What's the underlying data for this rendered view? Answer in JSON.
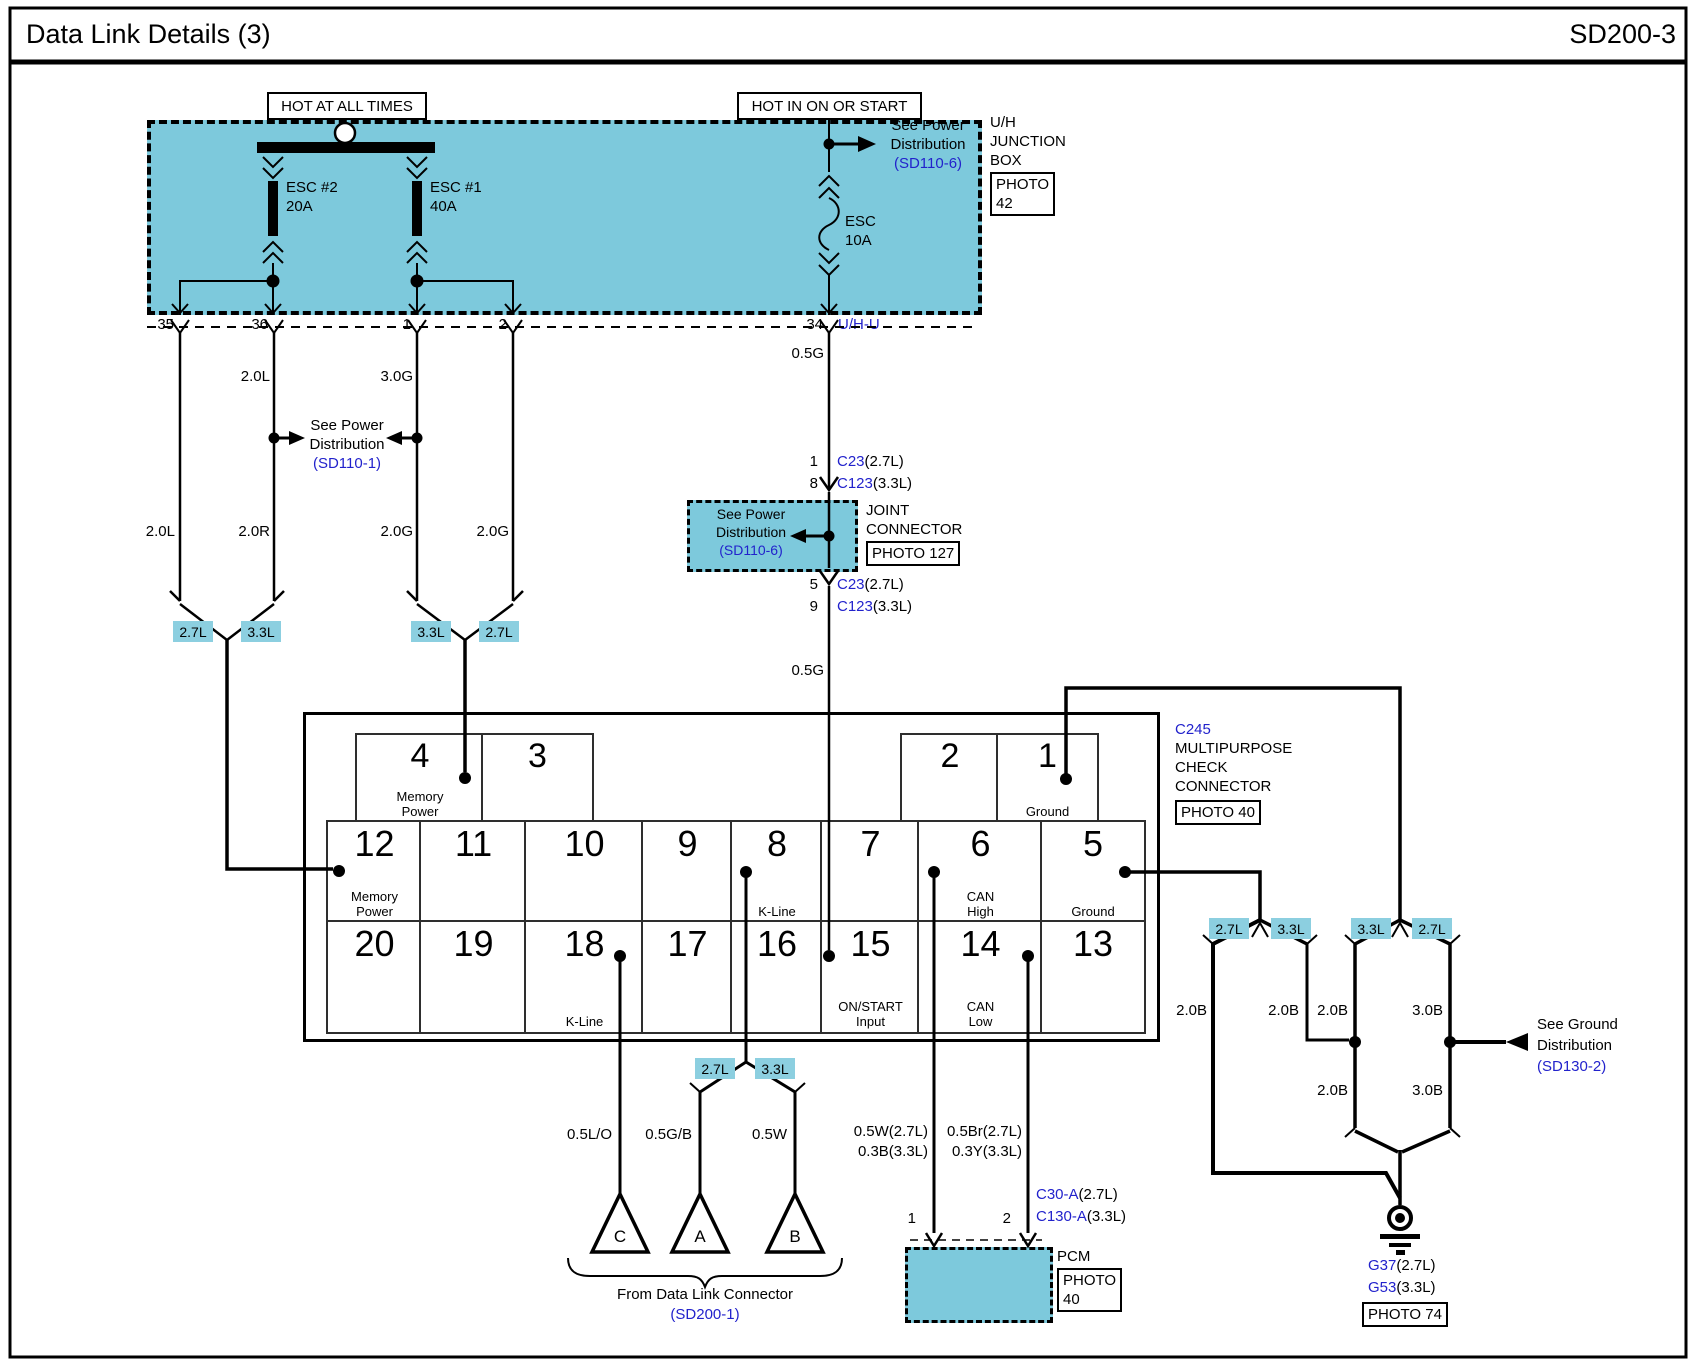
{
  "page": {
    "title": "Data Link Details (3)",
    "code": "SD200-3"
  },
  "colors": {
    "box_fill": "#7dc9dc",
    "tag_fill": "#8ccfe0",
    "link_blue": "#2222cc"
  },
  "top": {
    "hot1": "HOT AT ALL TIMES",
    "hot2": "HOT IN ON OR START",
    "fuse_esc2": {
      "name": "ESC #2",
      "amp": "20A"
    },
    "fuse_esc1": {
      "name": "ESC #1",
      "amp": "40A"
    },
    "fuse_esc": {
      "name": "ESC",
      "amp": "10A"
    },
    "see_power_right": {
      "l1": "See Power",
      "l2": "Distribution",
      "ref": "(SD110-6)"
    },
    "uh": {
      "l1": "U/H",
      "l2": "JUNCTION",
      "l3": "BOX",
      "photo1": "PHOTO",
      "photo2": "42"
    },
    "pins": {
      "p35": "35",
      "p36": "36",
      "p1": "1",
      "p2": "2",
      "p34": "34",
      "uhu": "U/H-U"
    }
  },
  "mid": {
    "w36": "2.0L",
    "w1": "3.0G",
    "w34": "0.5G",
    "w34b": "0.5G",
    "see_power": {
      "l1": "See Power",
      "l2": "Distribution",
      "ref": "(SD110-1)"
    },
    "low35": "2.0L",
    "low36": "2.0R",
    "low1": "2.0G",
    "low2": "2.0G",
    "tagL1": "2.7L",
    "tagL2": "3.3L",
    "tagR1": "3.3L",
    "tagR2": "2.7L"
  },
  "joint": {
    "p1": "1",
    "p8": "8",
    "p5": "5",
    "p9": "9",
    "c27": "C23",
    "c27e": "(2.7L)",
    "c33": "C123",
    "c33e": "(3.3L)",
    "see_power": {
      "l1": "See Power",
      "l2": "Distribution",
      "ref": "(SD110-6)"
    },
    "name1": "JOINT",
    "name2": "CONNECTOR",
    "photo": "PHOTO 127"
  },
  "connector": {
    "id": "C245",
    "n1": "MULTIPURPOSE",
    "n2": "CHECK",
    "n3": "CONNECTOR",
    "photo": "PHOTO 40",
    "top_left": [
      {
        "num": "4",
        "l1": "Memory",
        "l2": "Power"
      },
      {
        "num": "3",
        "l1": "",
        "l2": ""
      }
    ],
    "top_right": [
      {
        "num": "2",
        "l1": "",
        "l2": ""
      },
      {
        "num": "1",
        "l1": "Ground",
        "l2": ""
      }
    ],
    "row1": [
      {
        "num": "12",
        "l1": "Memory",
        "l2": "Power"
      },
      {
        "num": "11",
        "l1": "",
        "l2": ""
      },
      {
        "num": "10",
        "l1": "",
        "l2": ""
      },
      {
        "num": "9",
        "l1": "",
        "l2": ""
      },
      {
        "num": "8",
        "l1": "K-Line",
        "l2": ""
      },
      {
        "num": "7",
        "l1": "",
        "l2": ""
      },
      {
        "num": "6",
        "l1": "CAN",
        "l2": "High"
      },
      {
        "num": "5",
        "l1": "Ground",
        "l2": ""
      }
    ],
    "row2": [
      {
        "num": "20",
        "l1": "",
        "l2": ""
      },
      {
        "num": "19",
        "l1": "",
        "l2": ""
      },
      {
        "num": "18",
        "l1": "K-Line",
        "l2": ""
      },
      {
        "num": "17",
        "l1": "",
        "l2": ""
      },
      {
        "num": "16",
        "l1": "",
        "l2": ""
      },
      {
        "num": "15",
        "l1": "ON/START",
        "l2": "Input"
      },
      {
        "num": "14",
        "l1": "CAN",
        "l2": "Low"
      },
      {
        "num": "13",
        "l1": "",
        "l2": ""
      }
    ]
  },
  "bottom": {
    "w18": "0.5L/O",
    "wA": "0.5G/B",
    "wB": "0.5W",
    "tag27": "2.7L",
    "tag33": "3.3L",
    "triC": "C",
    "triA": "A",
    "triB": "B",
    "brace": "From Data Link Connector",
    "brace_ref": "(SD200-1)",
    "pcm_w1a": "0.5W(2.7L)",
    "pcm_w1b": "0.3B(3.3L)",
    "pcm_w2a": "0.5Br(2.7L)",
    "pcm_w2b": "0.3Y(3.3L)",
    "pcm": {
      "p1": "1",
      "p2": "2",
      "c27": "C30-A",
      "c27e": "(2.7L)",
      "c33": "C130-A",
      "c33e": "(3.3L)",
      "name": "PCM",
      "photo1": "PHOTO",
      "photo2": "40"
    }
  },
  "right": {
    "t1": "2.7L",
    "t2": "3.3L",
    "t3": "3.3L",
    "t4": "2.7L",
    "wl1": "2.0B",
    "wl2": "2.0B",
    "wl3": "2.0B",
    "wl4": "3.0B",
    "wl5": "2.0B",
    "wl6": "3.0B",
    "see_ground": {
      "l1": "See Ground",
      "l2": "Distribution",
      "ref": "(SD130-2)"
    },
    "g1": "G37",
    "g1e": "(2.7L)",
    "g2": "G53",
    "g2e": "(3.3L)",
    "photo": "PHOTO 74"
  }
}
